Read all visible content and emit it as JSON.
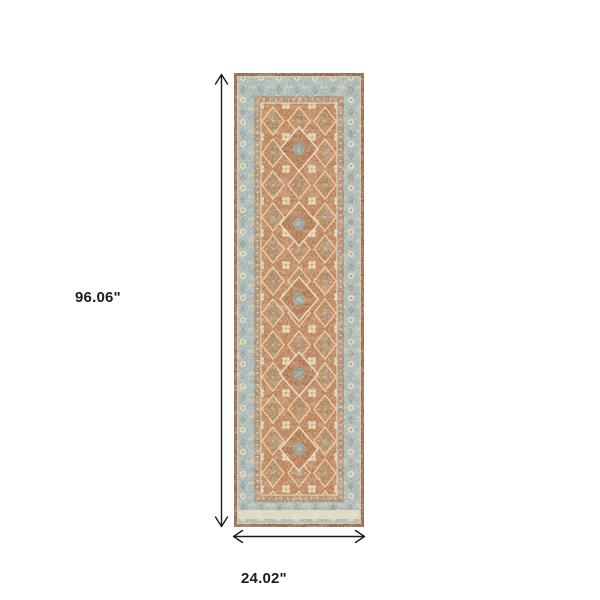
{
  "image": {
    "type": "product-dimensions-diagram",
    "background_color": "#ffffff"
  },
  "dimensions": {
    "height_label": "96.06\"",
    "width_label": "24.02\"",
    "arrow_color": "#1a1a1a",
    "label_color": "#1c1c1c"
  },
  "rug": {
    "description": "distressed vintage oriental runner rug, rust center field with light blue-grey border",
    "colors": {
      "outer_border_brown": "#8a6344",
      "edge_pinline_cream": "#cdbfa4",
      "border_band_blue": "#a3b3b0",
      "inner_guard_rust": "#a87049",
      "field_rust": "#b87c50",
      "ornament_cream": "#e4d6b8",
      "ornament_gold": "#d3a055",
      "ornament_olive": "#94905c",
      "ornament_slate_blue": "#7e99a0",
      "end_strip_cream": "#e0d8c2"
    }
  }
}
